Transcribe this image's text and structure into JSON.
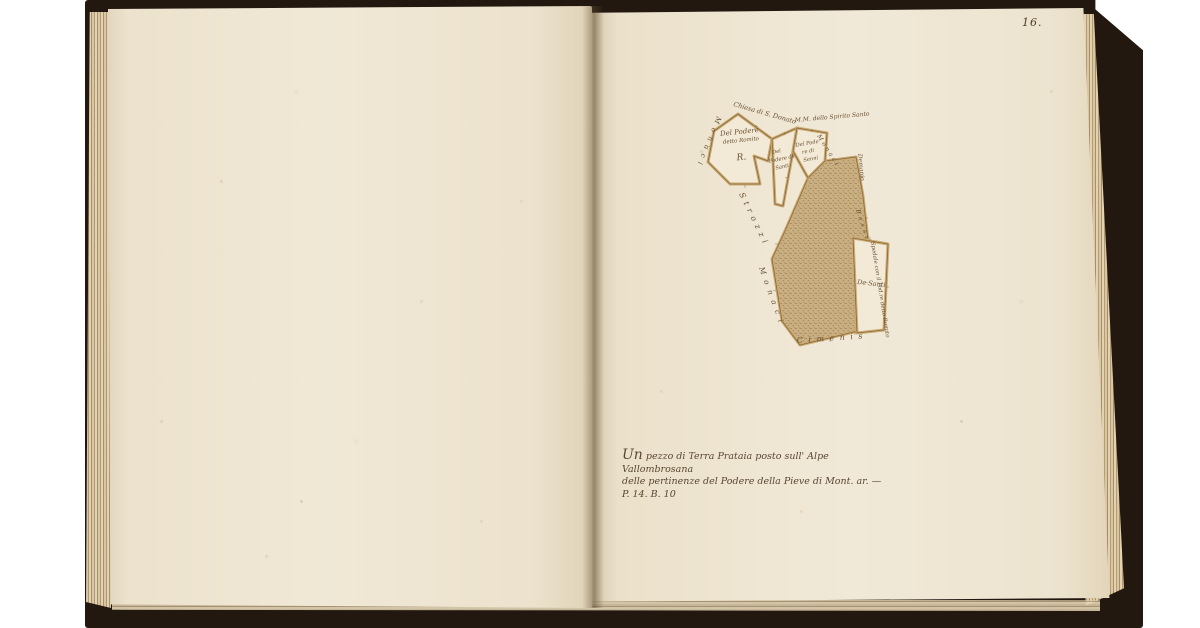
{
  "page_number": "16.",
  "caption": {
    "lead": "Un",
    "line1_rest": "pezzo di Terra Prataia posto sull' Alpe Vallombrosana",
    "line2": "delle pertinenze del Podere della Pieve di Mont. ar. — P. 14. B. 10"
  },
  "map": {
    "parcels": {
      "romito": {
        "line1": "Del Podere",
        "line2": "detto Romito",
        "mark": "R."
      },
      "santi": {
        "line1": "Del",
        "line2": "Podere de",
        "line3": "Santi"
      },
      "senni": {
        "line1": "Del Pode",
        "line2": "re di",
        "line3": "Senni"
      },
      "de_santi": {
        "label": "De Santi"
      }
    },
    "boundary_labels": {
      "chiesa": "Chiesa di S. Donato",
      "spirito_santo": "M.M. dello Spirito Santo",
      "monaci_upper": "Monaci",
      "strozzi": "Strozzi",
      "monaci_lower": "Monaci",
      "monaci_right": "Monaci",
      "demanio": "Demanio",
      "bassi": "Bassi",
      "spedale": "Spedale con il Pod.re detto Romito",
      "cimenis": "Cimenis"
    },
    "colors": {
      "ink": "#6b5233",
      "parcel_fill": "#f2ead7",
      "road": "#c9aa72",
      "meadow_base": "#c9af81",
      "meadow_dot": "#7d6136"
    }
  },
  "book": {
    "page_color": "#ece3d0",
    "cover_color": "#231810"
  }
}
